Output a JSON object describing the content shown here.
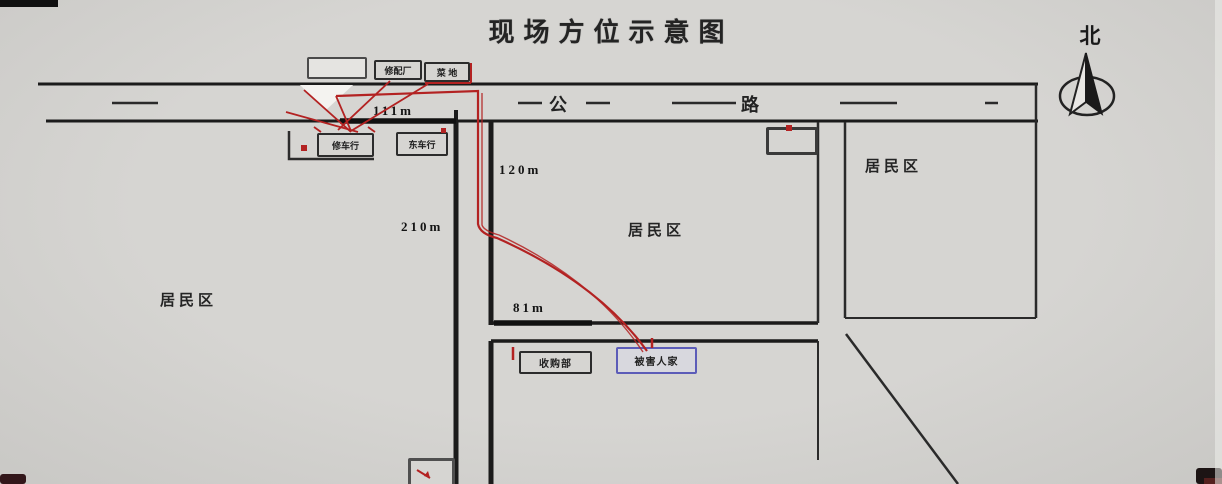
{
  "title": "现场方位示意图",
  "compass": {
    "north_label": "北"
  },
  "road": {
    "left_char": "公",
    "right_char": "路"
  },
  "areas": {
    "residential_left": "居民区",
    "residential_middle": "居民区",
    "residential_right": "居民区"
  },
  "buildings": {
    "repair_factory": "修配厂",
    "vegetable_plot": "菜 地",
    "west_bike_shop": "修车行",
    "east_bike_shop": "东车行",
    "purchase_station": "收购部",
    "victim_home": "被害人家"
  },
  "distances": {
    "road_north": "111m",
    "lane_east": "120m",
    "lane_west": "210m",
    "block_south": "81m"
  },
  "colors": {
    "background": "#d3d2cf",
    "ink": "#1b1b1b",
    "route_red": "#b32222",
    "victim_border_blue": "#5c5cb8"
  }
}
